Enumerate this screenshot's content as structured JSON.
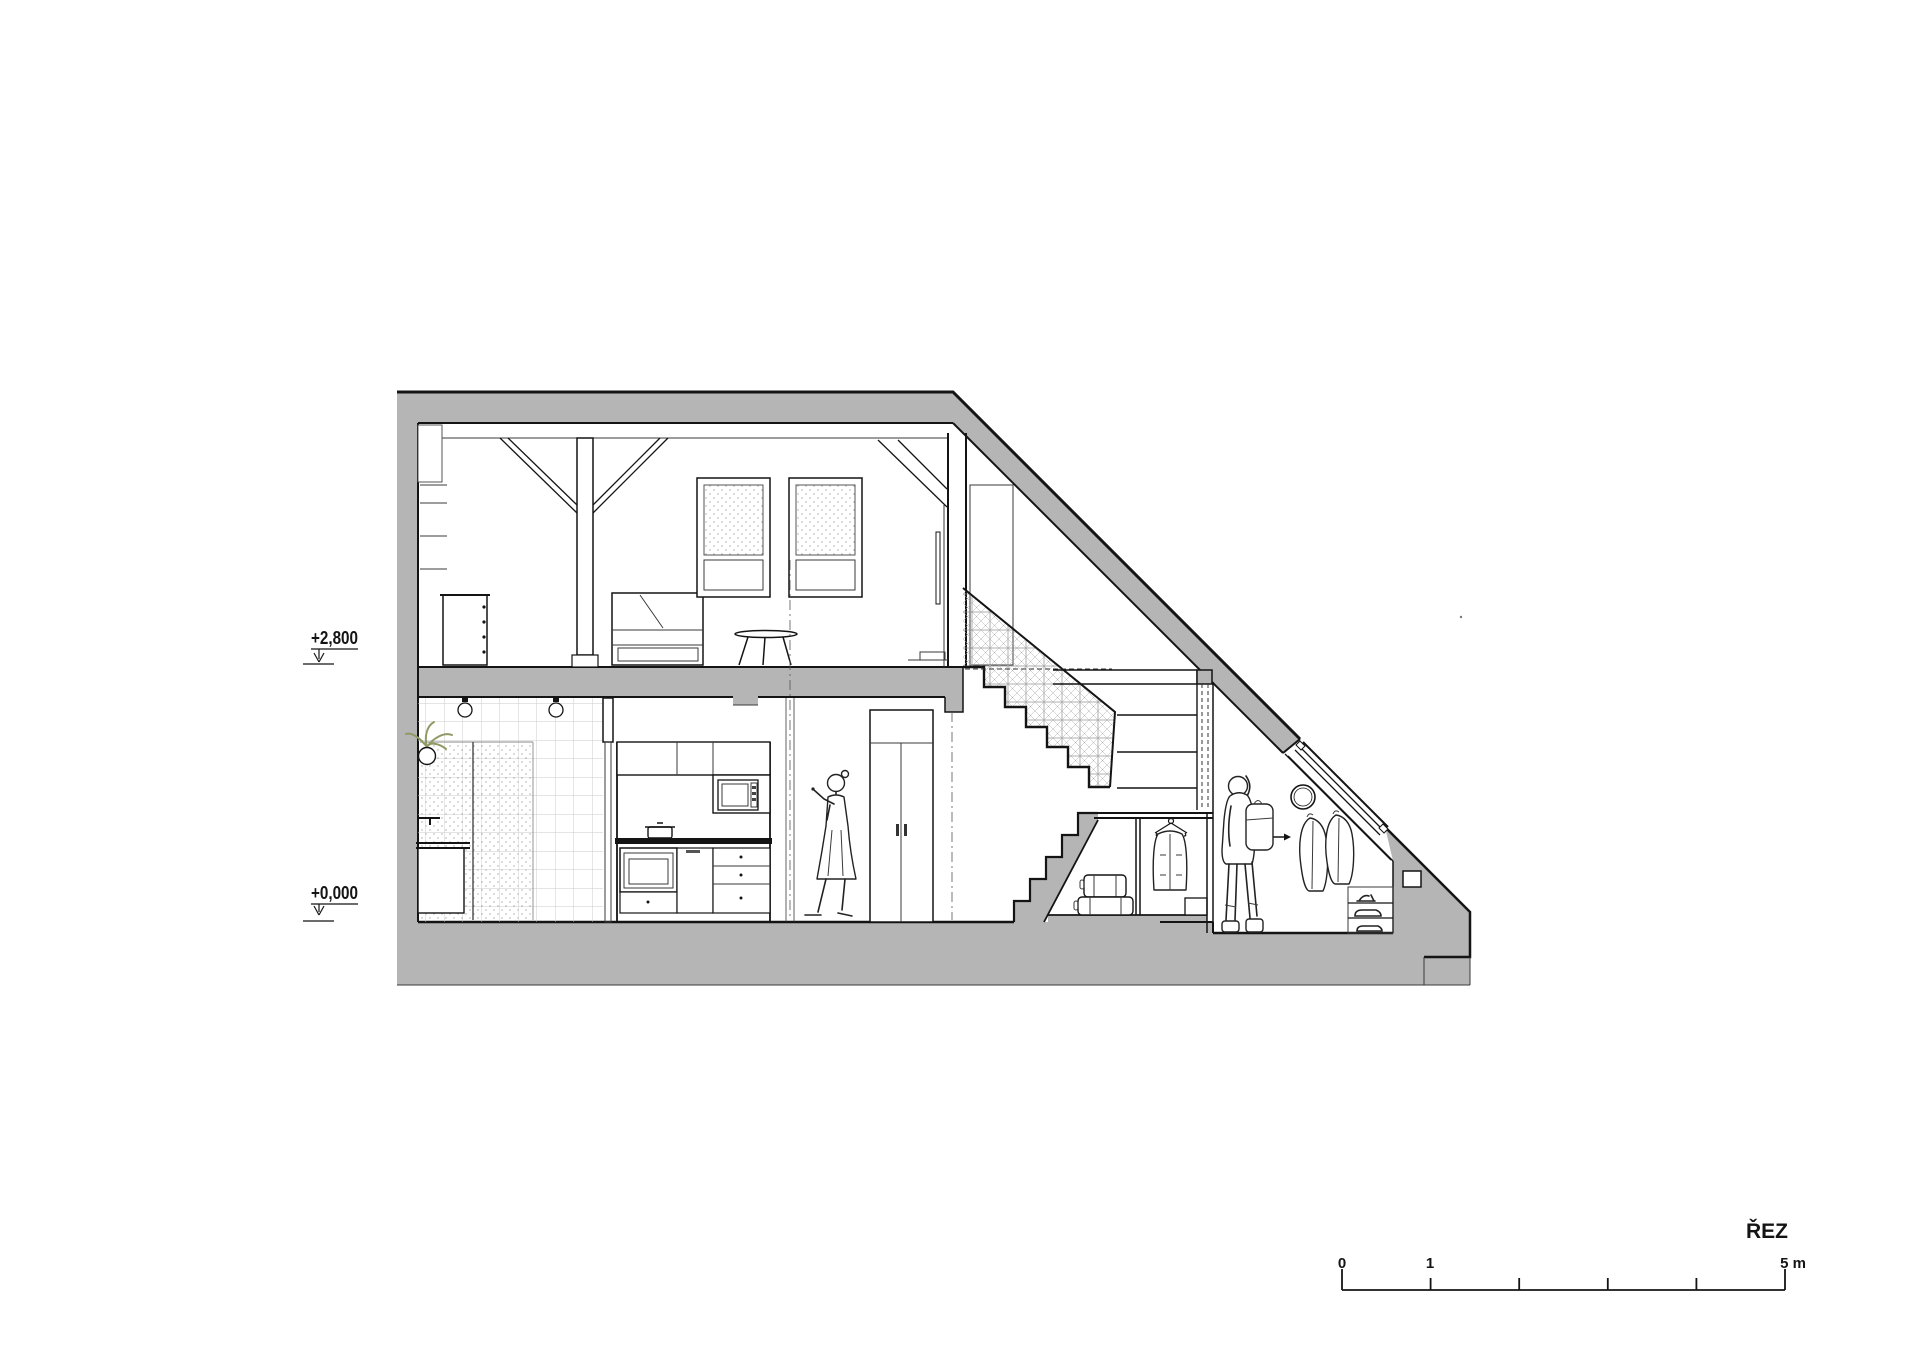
{
  "drawing": {
    "title": "ŘEZ",
    "levels": {
      "upper": "+2,800",
      "ground": "+0,000"
    },
    "scale_bar": {
      "start": "0",
      "mid": "1",
      "end": "5 m"
    },
    "colors": {
      "wall_fill": "#b5b5b5",
      "line": "#141414",
      "plant": "#8f9a64",
      "tile_grid": "#c9c9c9",
      "mesh": "#9a9a9a"
    }
  }
}
